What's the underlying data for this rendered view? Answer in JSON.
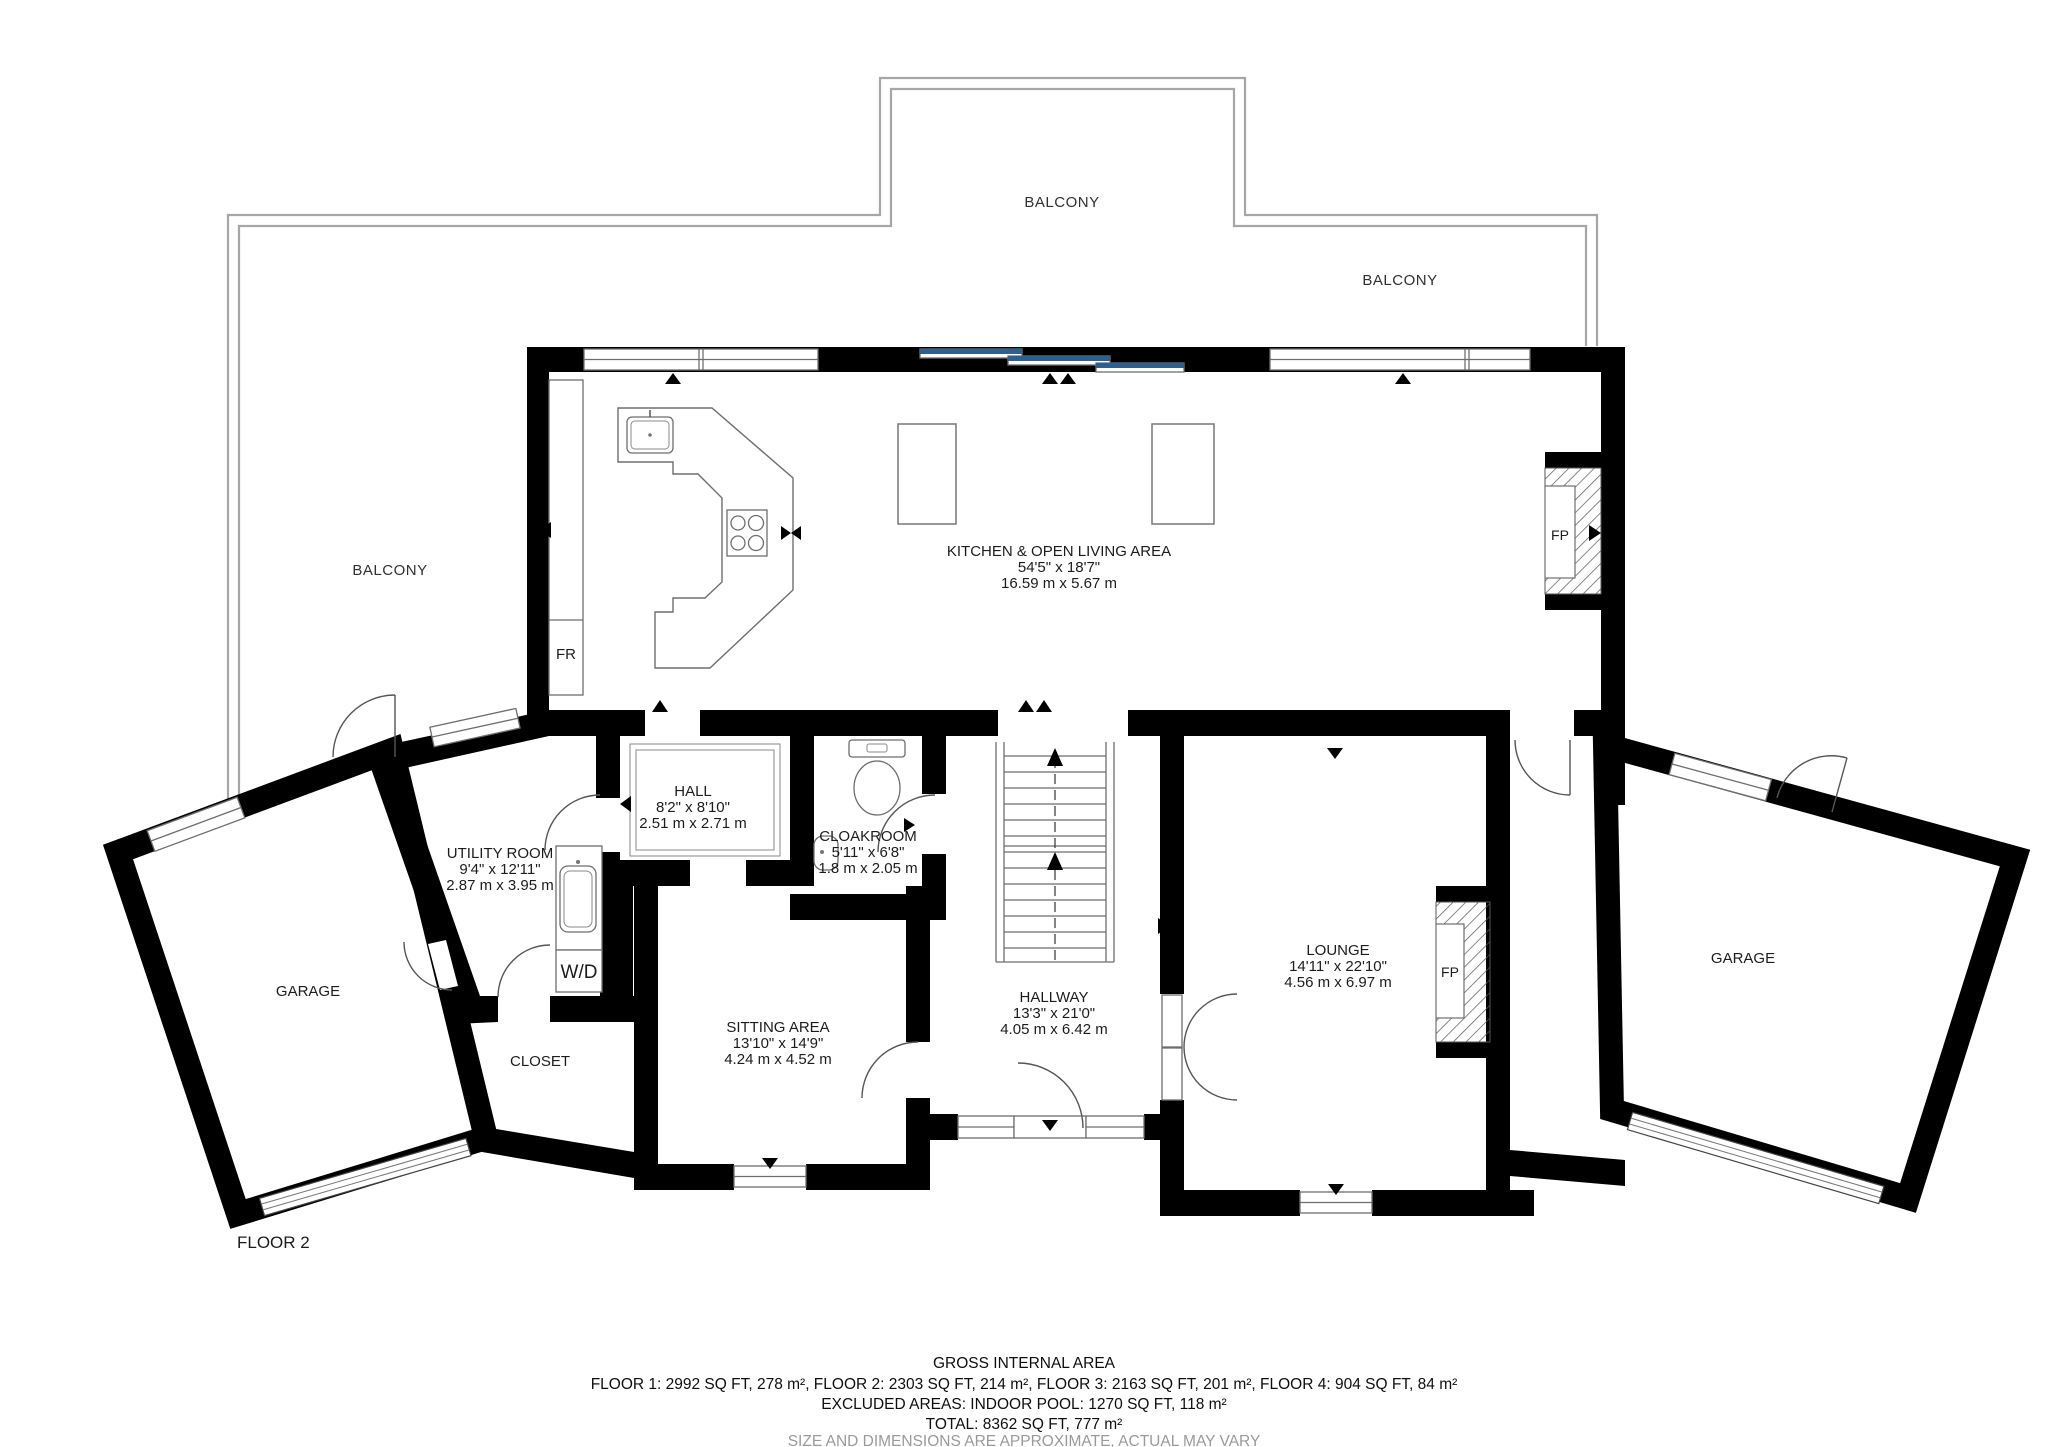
{
  "page": {
    "floor_label": "FLOOR 2"
  },
  "balconies": {
    "top": "BALCONY",
    "right": "BALCONY",
    "left": "BALCONY"
  },
  "rooms": {
    "kitchen": {
      "name": "KITCHEN & OPEN LIVING AREA",
      "dims_ft": "54'5\" x 18'7\"",
      "dims_m": "16.59 m x 5.67 m"
    },
    "hall": {
      "name": "HALL",
      "dims_ft": "8'2\" x 8'10\"",
      "dims_m": "2.51 m x 2.71 m"
    },
    "cloakroom": {
      "name": "CLOAKROOM",
      "dims_ft": "5'11\" x 6'8\"",
      "dims_m": "1.8 m x 2.05 m"
    },
    "utility": {
      "name": "UTILITY ROOM",
      "dims_ft": "9'4\" x 12'11\"",
      "dims_m": "2.87 m x 3.95 m"
    },
    "sitting": {
      "name": "SITTING AREA",
      "dims_ft": "13'10\" x 14'9\"",
      "dims_m": "4.24 m x 4.52 m"
    },
    "hallway": {
      "name": "HALLWAY",
      "dims_ft": "13'3\" x 21'0\"",
      "dims_m": "4.05 m x 6.42 m"
    },
    "lounge": {
      "name": "LOUNGE",
      "dims_ft": "14'11\" x 22'10\"",
      "dims_m": "4.56 m x 6.97 m"
    },
    "garage_left": {
      "name": "GARAGE"
    },
    "garage_right": {
      "name": "GARAGE"
    },
    "closet": {
      "name": "CLOSET"
    }
  },
  "fixtures": {
    "fridge": "FR",
    "washer_dryer": "W/D",
    "fireplace_kitchen": "FP",
    "fireplace_lounge": "FP"
  },
  "footer": {
    "line1": "GROSS INTERNAL AREA",
    "line2": "FLOOR 1: 2992 SQ FT, 278 m², FLOOR 2: 2303 SQ FT, 214 m², FLOOR 3: 2163 SQ FT, 201 m², FLOOR 4: 904 SQ FT, 84 m²",
    "line3": "EXCLUDED AREAS: INDOOR POOL: 1270 SQ FT, 118 m²",
    "line4": "TOTAL: 8362 SQ FT, 777 m²",
    "line5": "SIZE AND DIMENSIONS ARE APPROXIMATE, ACTUAL MAY VARY"
  },
  "colors": {
    "wall": "#000000",
    "outline_gray": "#6e6e6e",
    "balcony_line": "#a6a6a6",
    "slider_blue": "#2e608f",
    "text_dark": "#1c1c1c",
    "footer_muted": "#9a9a9a"
  }
}
